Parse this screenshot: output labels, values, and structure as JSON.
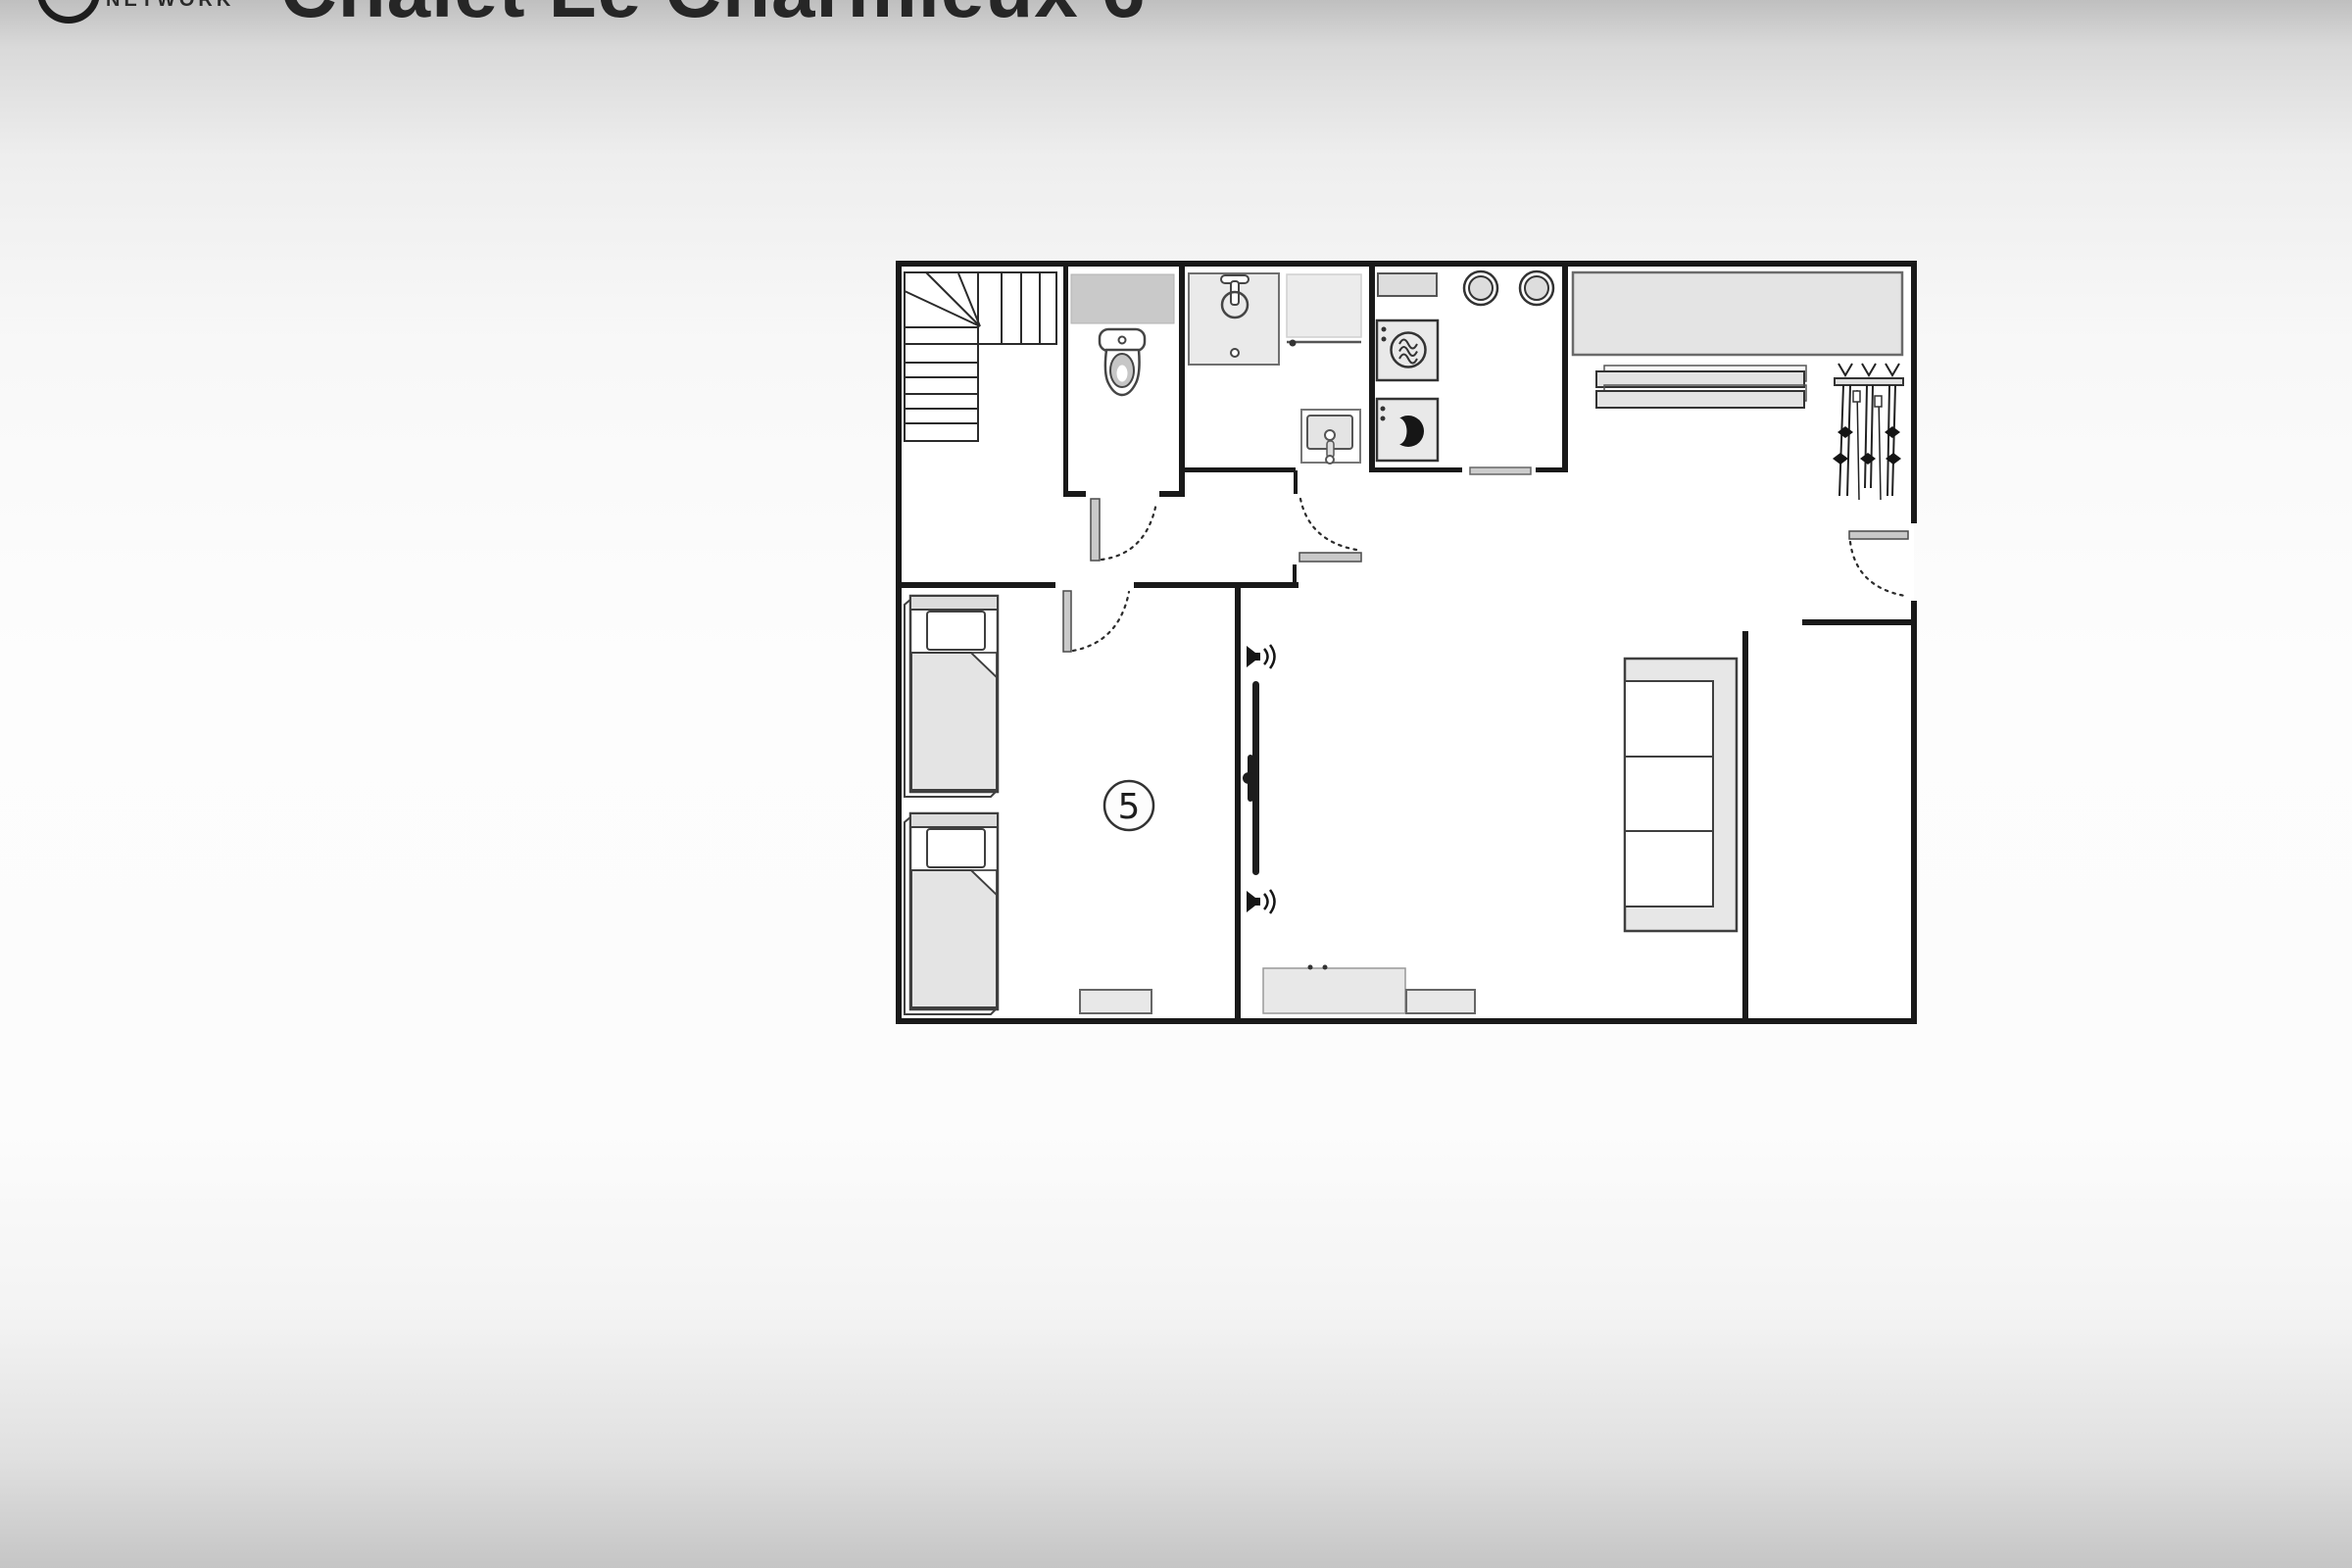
{
  "header": {
    "brand": "NETWORK",
    "title": "Chalet Le Charmieux 6"
  },
  "floor_plan": {
    "room_label": "5",
    "rooms": [
      "staircase-hall",
      "wc",
      "shower-room",
      "kitchen",
      "ski-entry",
      "bedroom",
      "living-room",
      "side-room"
    ],
    "furniture_icons": [
      "staircase",
      "toilet",
      "wall-shelf",
      "shower-tray",
      "vanity-counter",
      "washbasin",
      "worktop",
      "hob-ring",
      "hob-ring",
      "oven",
      "washing-machine",
      "wardrobe-counter",
      "storage-shelves",
      "ski-rack",
      "skis-and-poles",
      "single-bed",
      "single-bed",
      "radiator",
      "radiator",
      "wall-tv",
      "speaker",
      "speaker",
      "sofa",
      "sideboard",
      "door-threshold"
    ],
    "doors": [
      "wc-door",
      "bathroom-door",
      "bedroom-door",
      "entry-door"
    ]
  },
  "colors": {
    "wall": "#191919",
    "outline": "#3f3f3f",
    "fill_light": "#e7e7e7",
    "fill_mid": "#c9c9c9",
    "page_top": "#bfbfbf",
    "page_middle": "#fdfdfd",
    "page_bottom": "#c5c5c5"
  }
}
